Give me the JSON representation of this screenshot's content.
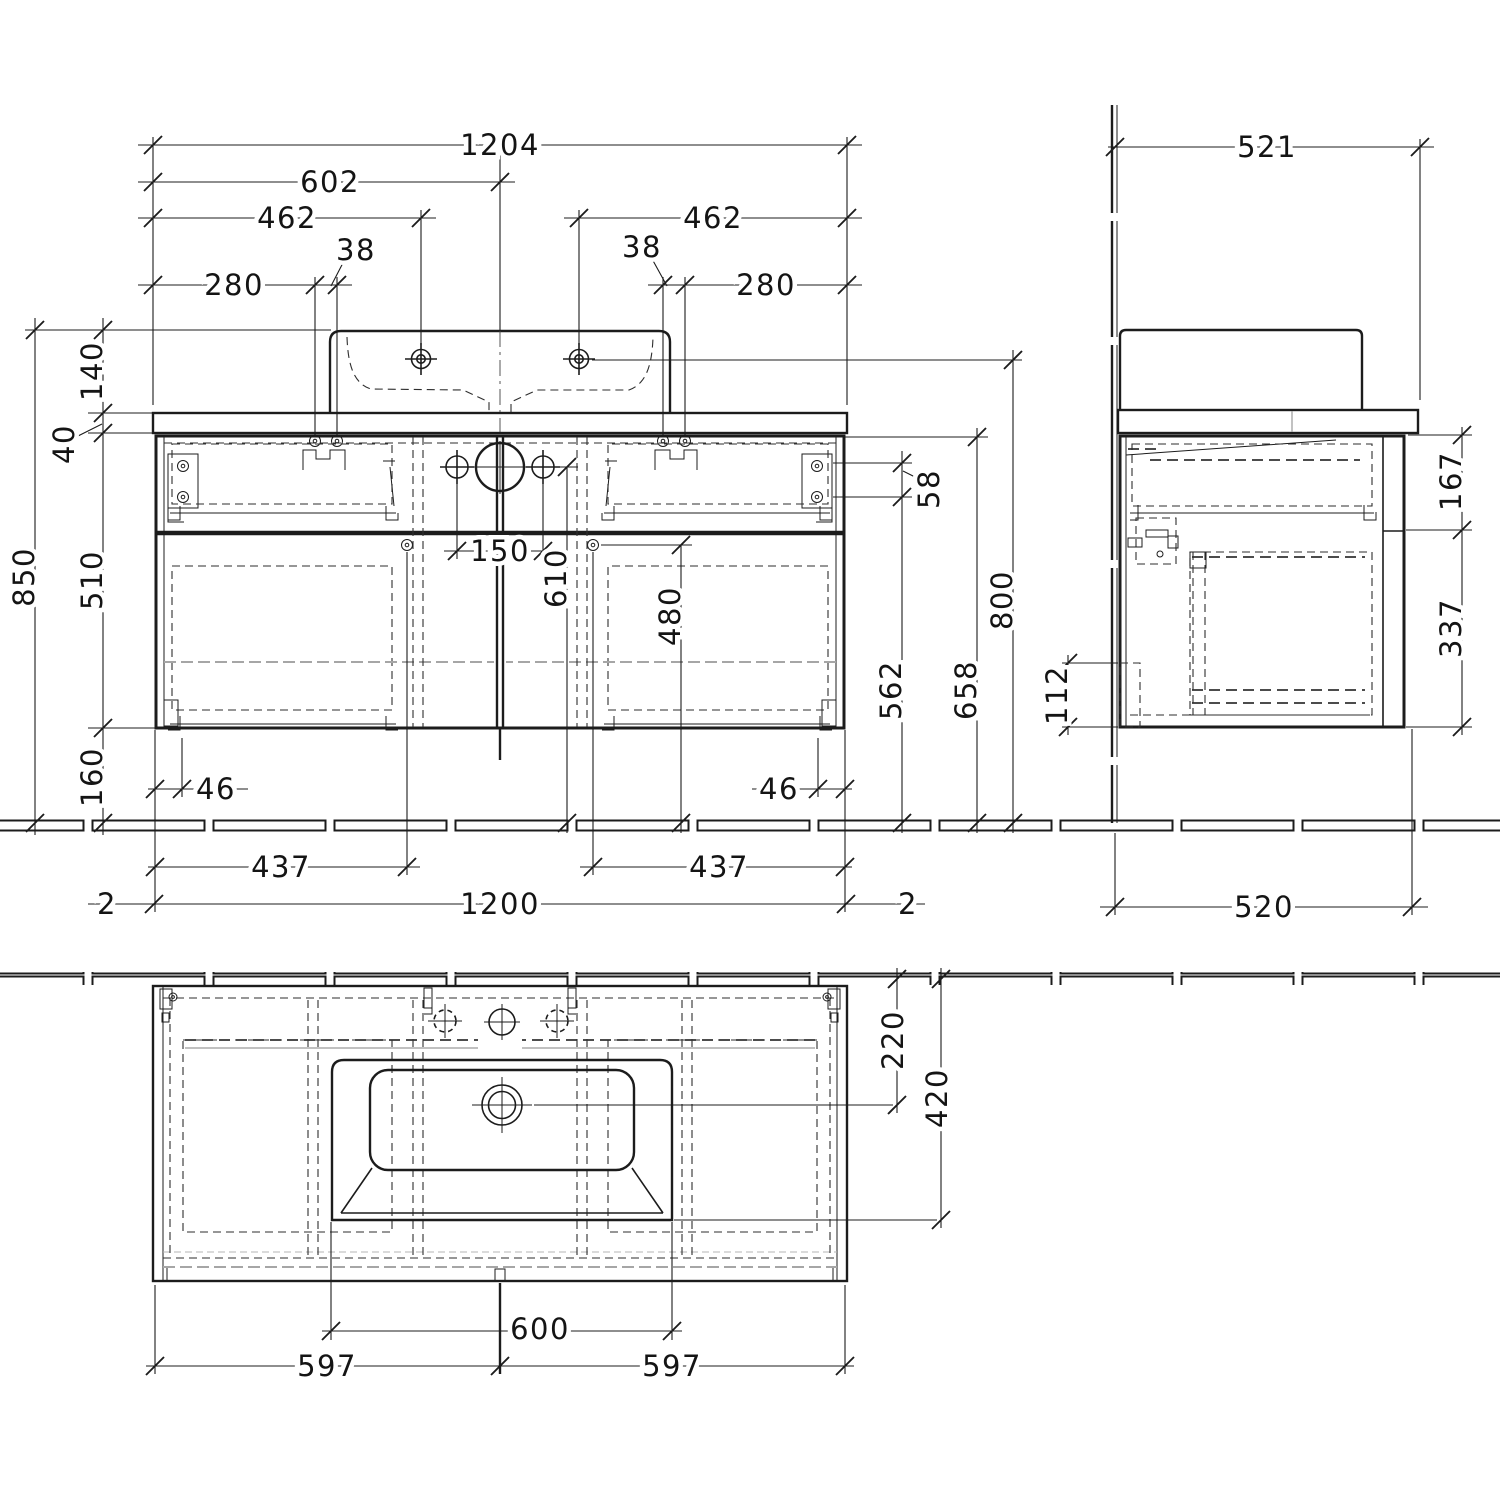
{
  "colors": {
    "line": "#1c1c1c",
    "light_gray": "#9a9a9a",
    "background": "#ffffff"
  },
  "views": {
    "front": {
      "total_width_with_top": "1204",
      "center_offset": "602",
      "tap_hole_offset": "462",
      "fixing_hole_spacing": "38",
      "fixing_hole_offset": "280",
      "basin_height": "140",
      "top_thickness": "40",
      "overall_height": "850",
      "cabinet_height": "510",
      "bottom_clearance": "160",
      "pipe_hole_spacing": "150",
      "pipe_hole_height": "610",
      "rail_screw_height": "480",
      "bracket_screw_spacing": "58",
      "bracket_height": "562",
      "cabinet_top_height": "658",
      "tap_hole_height": "800",
      "rail_inset": "46",
      "rail_span": "437",
      "top_overhang": "2",
      "cabinet_width": "1200"
    },
    "side": {
      "top_depth": "521",
      "top_drawer_height": "167",
      "bottom_drawer_height": "337",
      "recess_height": "112",
      "cabinet_depth": "520"
    },
    "plan": {
      "drain_to_wall": "220",
      "basin_front_to_wall": "420",
      "basin_cutout_width": "600",
      "half_width": "597"
    }
  }
}
